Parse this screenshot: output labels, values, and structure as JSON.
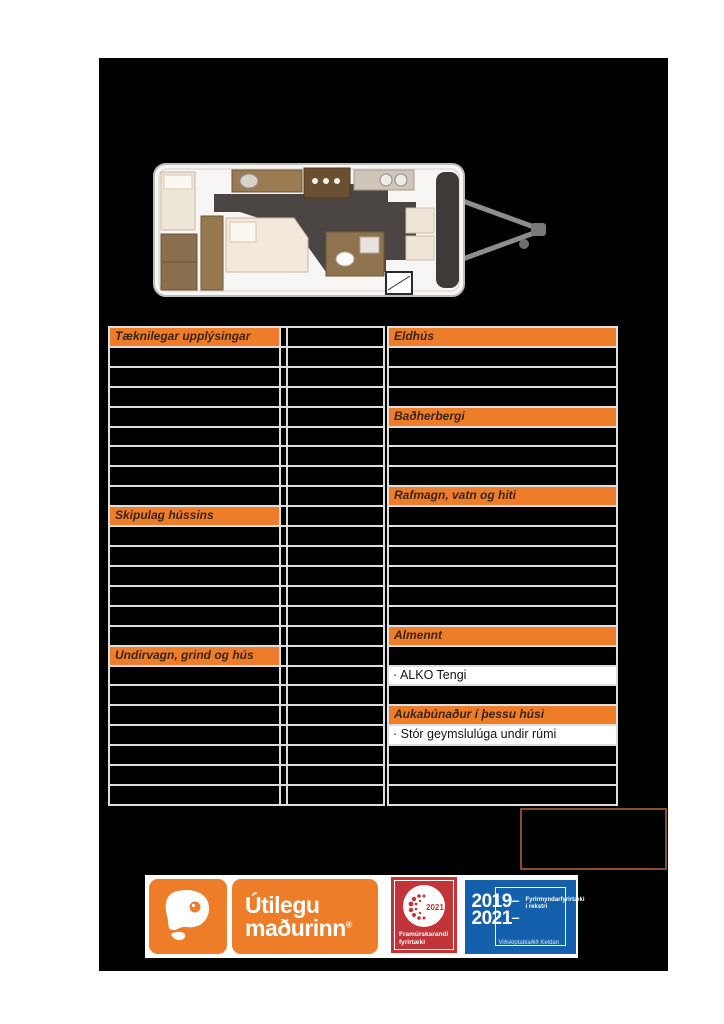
{
  "colors": {
    "accent_orange": "#EE7D2A",
    "badge_red": "#C23438",
    "badge_blue": "#1560AC",
    "note_box_border": "#8A4B2E",
    "panel_black": "#000000"
  },
  "floorplan": {
    "alt": "caravan-floorplan-top-view"
  },
  "tables": {
    "left": {
      "headers": {
        "technical": "Tæknilegar upplýsingar",
        "layout": "Skipulag hússins",
        "chassis": "Undirvagn, grind og hús"
      }
    },
    "right": {
      "headers": {
        "kitchen": "Eldhús",
        "bathroom": "Baðherbergi",
        "power": "Rafmagn, vatn og hiti",
        "general": "Almennt",
        "extras": "Aukabúnaður í þessu húsi"
      },
      "general_items": [
        "· ALKO Tengi"
      ],
      "extras_items": [
        "· Stór geymslulúga undir rúmi"
      ]
    }
  },
  "logos": {
    "utilegumadurinn": {
      "name_line1": "Útilegu",
      "name_line2": "maðurinn",
      "reg": "®"
    },
    "framurskarandi": {
      "year": "2021",
      "label_line1": "Framúrskarandi",
      "label_line2": "fyrirtæki"
    },
    "fyrirmyndar": {
      "year_from": "2019",
      "year_to": "2021",
      "dash": "–",
      "label_line1": "Fyrirmyndarfyrirtæki",
      "label_line2": "í rekstri",
      "source": "Viðskiptablaðið  Keldan"
    }
  }
}
